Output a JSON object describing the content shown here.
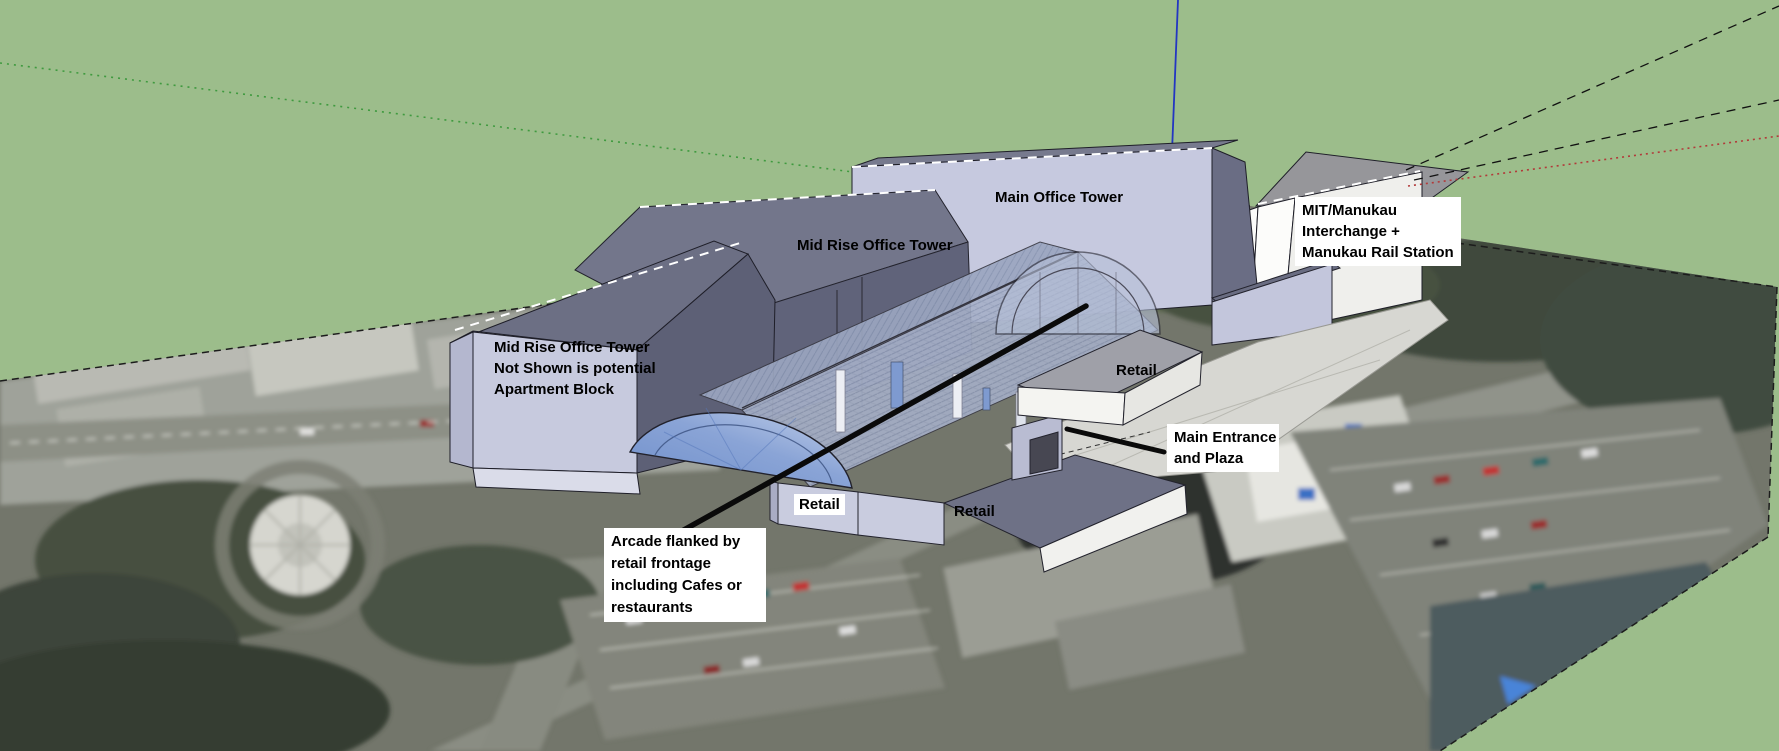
{
  "scene": {
    "app": "3D massing concept viewport",
    "background_color": "#9cbd8b",
    "axis_colors": {
      "blue": "#2336c2",
      "green": "#3f9a3f",
      "red": "#b23a3a"
    },
    "building_colors": {
      "face_lavender": "#c6c9df",
      "roof_dark": "#6e7186",
      "glass_blue": "#7e9bd2",
      "white_block": "#f2f2ef",
      "plaza": "#d7d7d2",
      "label_background": "#ffffff",
      "label_text": "#000000"
    }
  },
  "annotations": {
    "main_office_tower": {
      "text": "Main Office Tower"
    },
    "mid_rise_roof": {
      "text": "Mid Rise Office Tower"
    },
    "mid_rise_front": {
      "lines": [
        "Mid Rise Office Tower",
        "Not Shown is potential",
        "Apartment Block"
      ]
    },
    "mit_interchange": {
      "lines": [
        "MIT/Manukau",
        "Interchange +",
        "Manukau Rail Station"
      ]
    },
    "main_entrance": {
      "lines": [
        "Main Entrance",
        "and Plaza"
      ]
    },
    "arcade": {
      "lines": [
        "Arcade flanked by",
        "retail frontage",
        "including Cafes or",
        "restaurants"
      ]
    },
    "retail_west": {
      "text": "Retail"
    },
    "retail_south": {
      "text": "Retail"
    },
    "retail_east": {
      "text": "Retail"
    }
  }
}
